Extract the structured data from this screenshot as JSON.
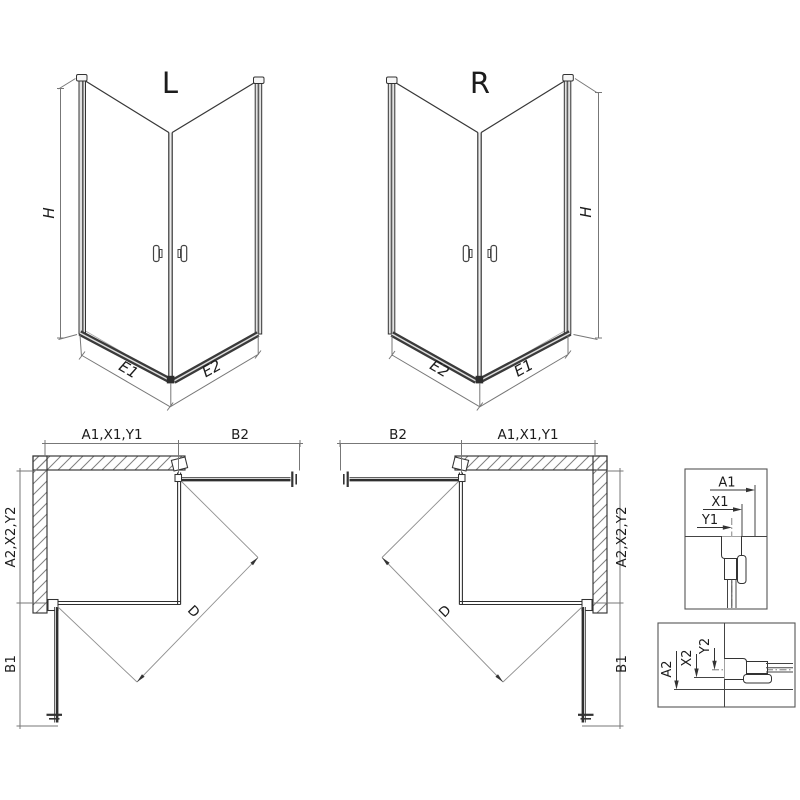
{
  "drawing": {
    "perspective_left": {
      "variant_label": "L",
      "height_dim": "H",
      "bottom_left_dim": "E1",
      "bottom_right_dim": "E2"
    },
    "perspective_right": {
      "variant_label": "R",
      "height_dim": "H",
      "bottom_left_dim": "E2",
      "bottom_right_dim": "E1"
    },
    "plan_left": {
      "top_dim": "A1,X1,Y1",
      "door_top_dim": "B2",
      "side_dim": "A2,X2,Y2",
      "door_side_dim": "B1",
      "diagonal_dim": "D"
    },
    "plan_right": {
      "door_top_dim": "B2",
      "top_dim": "A1,X1,Y1",
      "side_dim": "A2,X2,Y2",
      "door_side_dim": "B1",
      "diagonal_dim": "D"
    },
    "detail_wall_profile_top": {
      "dims": [
        "A1",
        "X1",
        "Y1"
      ]
    },
    "detail_wall_profile_side": {
      "dims": [
        "A2",
        "X2",
        "Y2"
      ]
    },
    "colors": {
      "line": "#2f2f2f",
      "dimension_line": "#777777",
      "hatch": "#808080",
      "background": "#ffffff"
    }
  }
}
